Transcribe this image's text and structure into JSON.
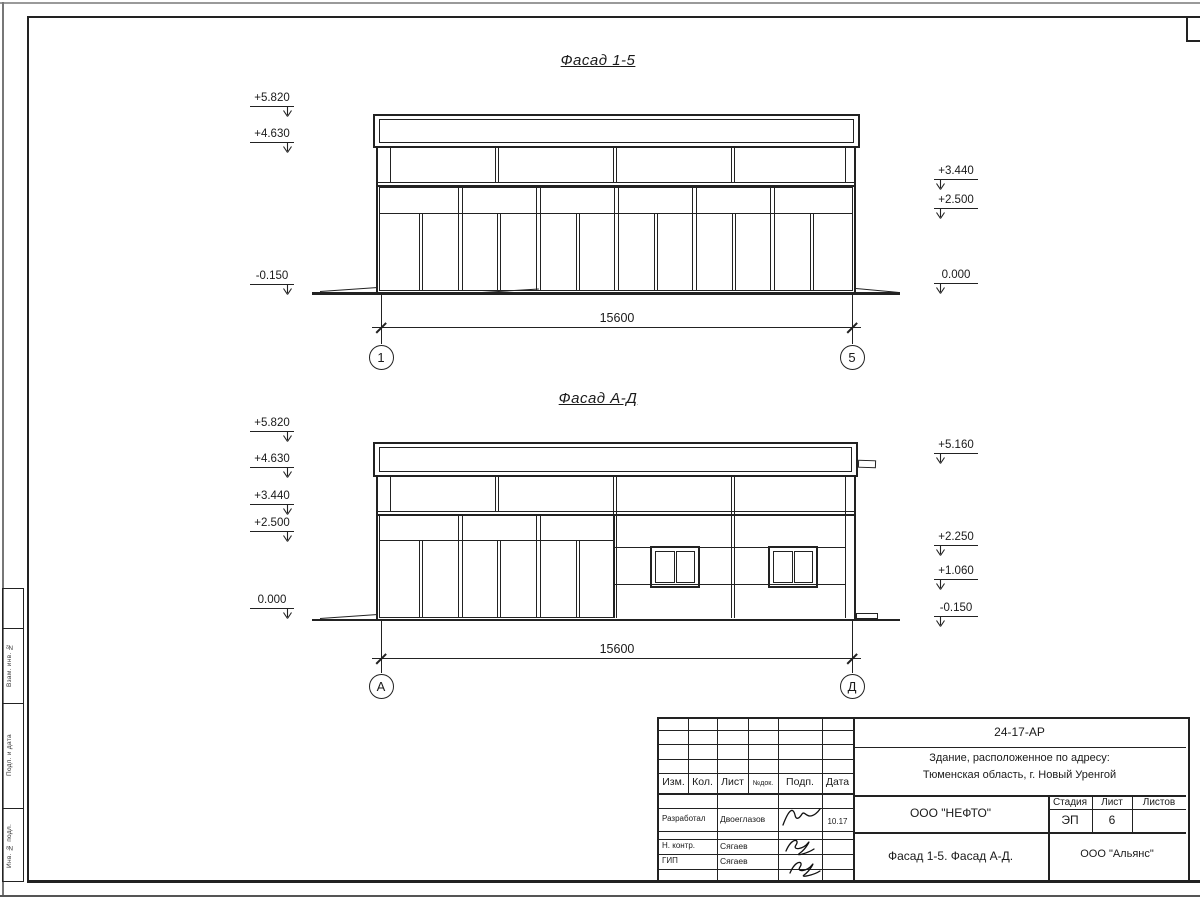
{
  "sheet": {
    "facades": [
      {
        "title": "Фасад 1-5",
        "dimension": "15600",
        "axes": [
          "1",
          "5"
        ],
        "elevations_left": [
          "+5.820",
          "+4.630",
          "-0.150"
        ],
        "elevations_right": [
          "+3.440",
          "+2.500",
          "0.000"
        ]
      },
      {
        "title": "Фасад А-Д",
        "dimension": "15600",
        "axes": [
          "А",
          "Д"
        ],
        "elevations_left": [
          "+5.820",
          "+4.630",
          "+3.440",
          "+2.500",
          "0.000"
        ],
        "elevations_right": [
          "+5.160",
          "+2.250",
          "+1.060",
          "-0.150"
        ]
      }
    ]
  },
  "title_block": {
    "doc_number": "24-17-АР",
    "address_line1": "Здание, расположенное по адресу:",
    "address_line2": "Тюменская область, г. Новый Уренгой",
    "revision_headers": [
      "Изм.",
      "Кол.",
      "Лист",
      "№док.",
      "Подп.",
      "Дата"
    ],
    "signature_rows": [
      {
        "role": "Разработал",
        "name": "Двоеглазов",
        "date": "10.17"
      },
      {
        "role": "Н. контр.",
        "name": "Сягаев",
        "date": ""
      },
      {
        "role": "ГИП",
        "name": "Сягаев",
        "date": ""
      }
    ],
    "contractor": "ООО \"НЕФТО\"",
    "stage_header": "Стадия",
    "sheet_header": "Лист",
    "sheets_header": "Листов",
    "stage": "ЭП",
    "sheet_number": "6",
    "sheets_total": "",
    "sheet_title": "Фасад 1-5. Фасад А-Д.",
    "client": "ООО \"Альянс\""
  },
  "margin_stamp": {
    "labels": [
      "Взам. инв. №",
      "Подп. и дата",
      "Инв. № подл."
    ]
  },
  "colors": {
    "line": "#222222",
    "frame_outer": "#9a9a9a",
    "background": "#ffffff"
  }
}
